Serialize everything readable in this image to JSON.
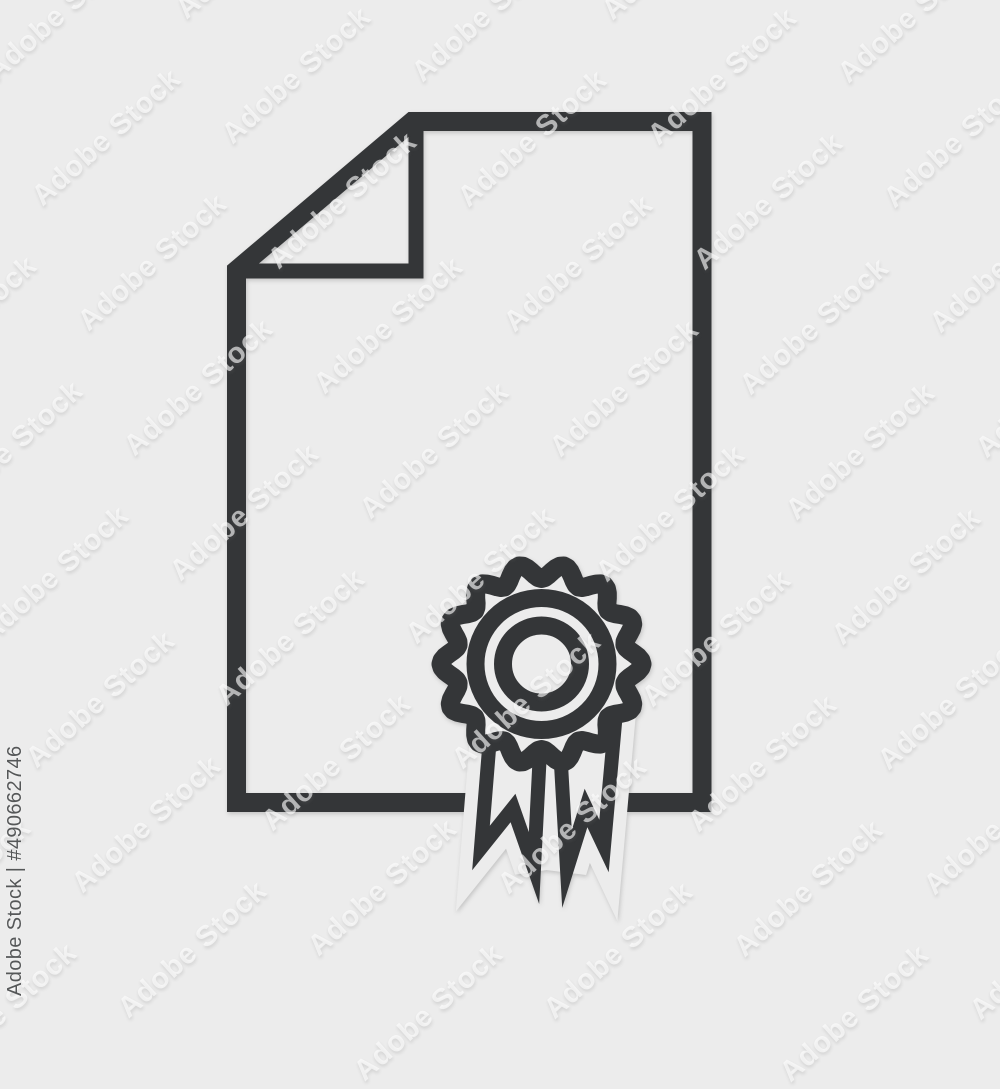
{
  "background_color": "#ececec",
  "icon": {
    "name": "certificate-award-document-icon",
    "stroke_color": "#343638",
    "halo_color": "#ececec",
    "parts": [
      "document-outline",
      "folded-corner",
      "award-rosette",
      "ribbon-left",
      "ribbon-right"
    ]
  },
  "watermark": {
    "tile_text": "Adobe Stock",
    "credit_text": "Adobe Stock | #490662746"
  }
}
